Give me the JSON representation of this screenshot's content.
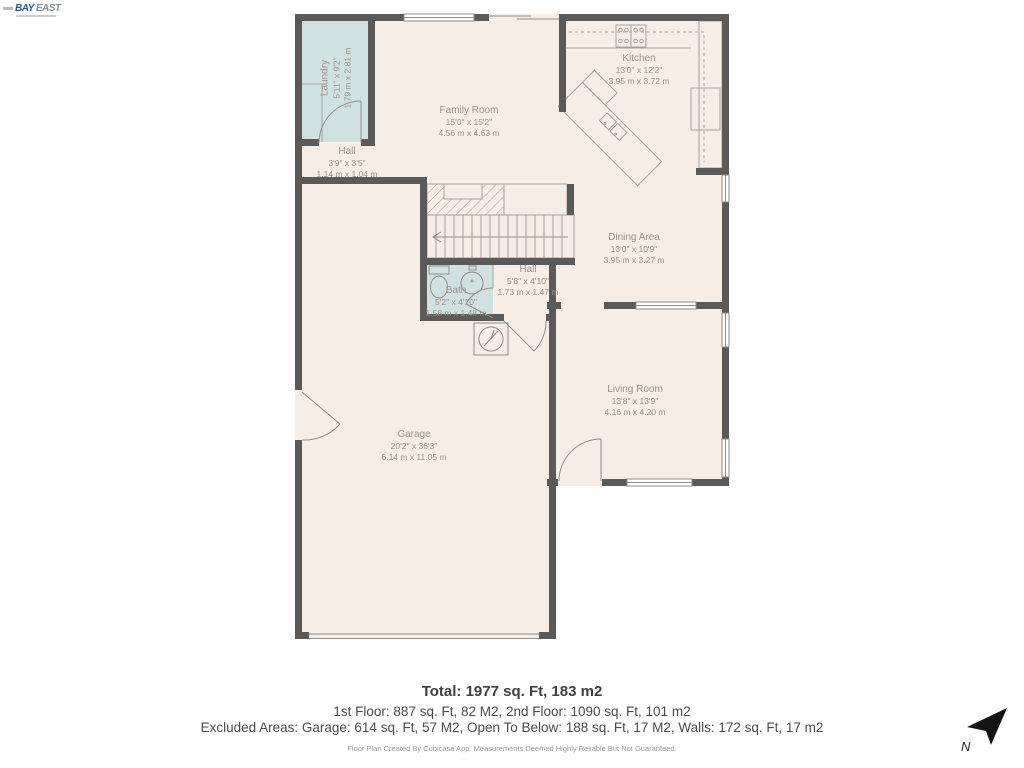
{
  "logo": {
    "part1": "BAY",
    "part2": "EAST"
  },
  "plan": {
    "rooms": {
      "laundry": {
        "name": "Laundry",
        "imperial": "5'11\" x 9'2\"",
        "metric": "1.79 m x 2.81 m"
      },
      "hall_upper": {
        "name": "Hall",
        "imperial": "3'9\" x 3'5\"",
        "metric": "1.14 m x 1.04 m"
      },
      "family_room": {
        "name": "Family Room",
        "imperial": "15'0\" x 15'2\"",
        "metric": "4.56 m x 4.63 m"
      },
      "kitchen": {
        "name": "Kitchen",
        "imperial": "13'0\" x 12'2\"",
        "metric": "3.95 m x 3.72 m"
      },
      "dining_area": {
        "name": "Dining Area",
        "imperial": "13'0\" x 10'9\"",
        "metric": "3.95 m x 3.27 m"
      },
      "bath": {
        "name": "Bath",
        "imperial": "5'2\" x 4'10\"",
        "metric": "1.58 m x 1.48 m"
      },
      "hall_entry": {
        "name": "Hall",
        "imperial": "5'8\" x 4'10\"",
        "metric": "1.73 m x 1.47 m"
      },
      "living_room": {
        "name": "Living Room",
        "imperial": "13'8\" x 13'9\"",
        "metric": "4.16 m x 4.20 m"
      },
      "garage": {
        "name": "Garage",
        "imperial": "20'2\" x 36'3\"",
        "metric": "6.14 m x 11.05 m"
      }
    }
  },
  "summary": {
    "total": "Total: 1977 sq. Ft, 183 m2",
    "floors": "1st Floor: 887 sq. Ft, 82 M2, 2nd Floor: 1090 sq. Ft, 101 m2",
    "excluded": "Excluded Areas: Garage: 614 sq. Ft, 57 M2, Open To Below: 188 sq. Ft, 17 M2, Walls: 172 sq. Ft, 17 m2",
    "disclaimer": "Floor Plan Created By Cubicasa App. Measurements Deemed Highly Reliable But Not Guaranteed."
  },
  "compass": {
    "north_label": "N"
  },
  "colors": {
    "wall": "#5c5a58",
    "floor": "#f6ede6",
    "wet_room": "#cfe2e0",
    "label_text": "#9a9189",
    "logo_blue": "#2456a4"
  }
}
